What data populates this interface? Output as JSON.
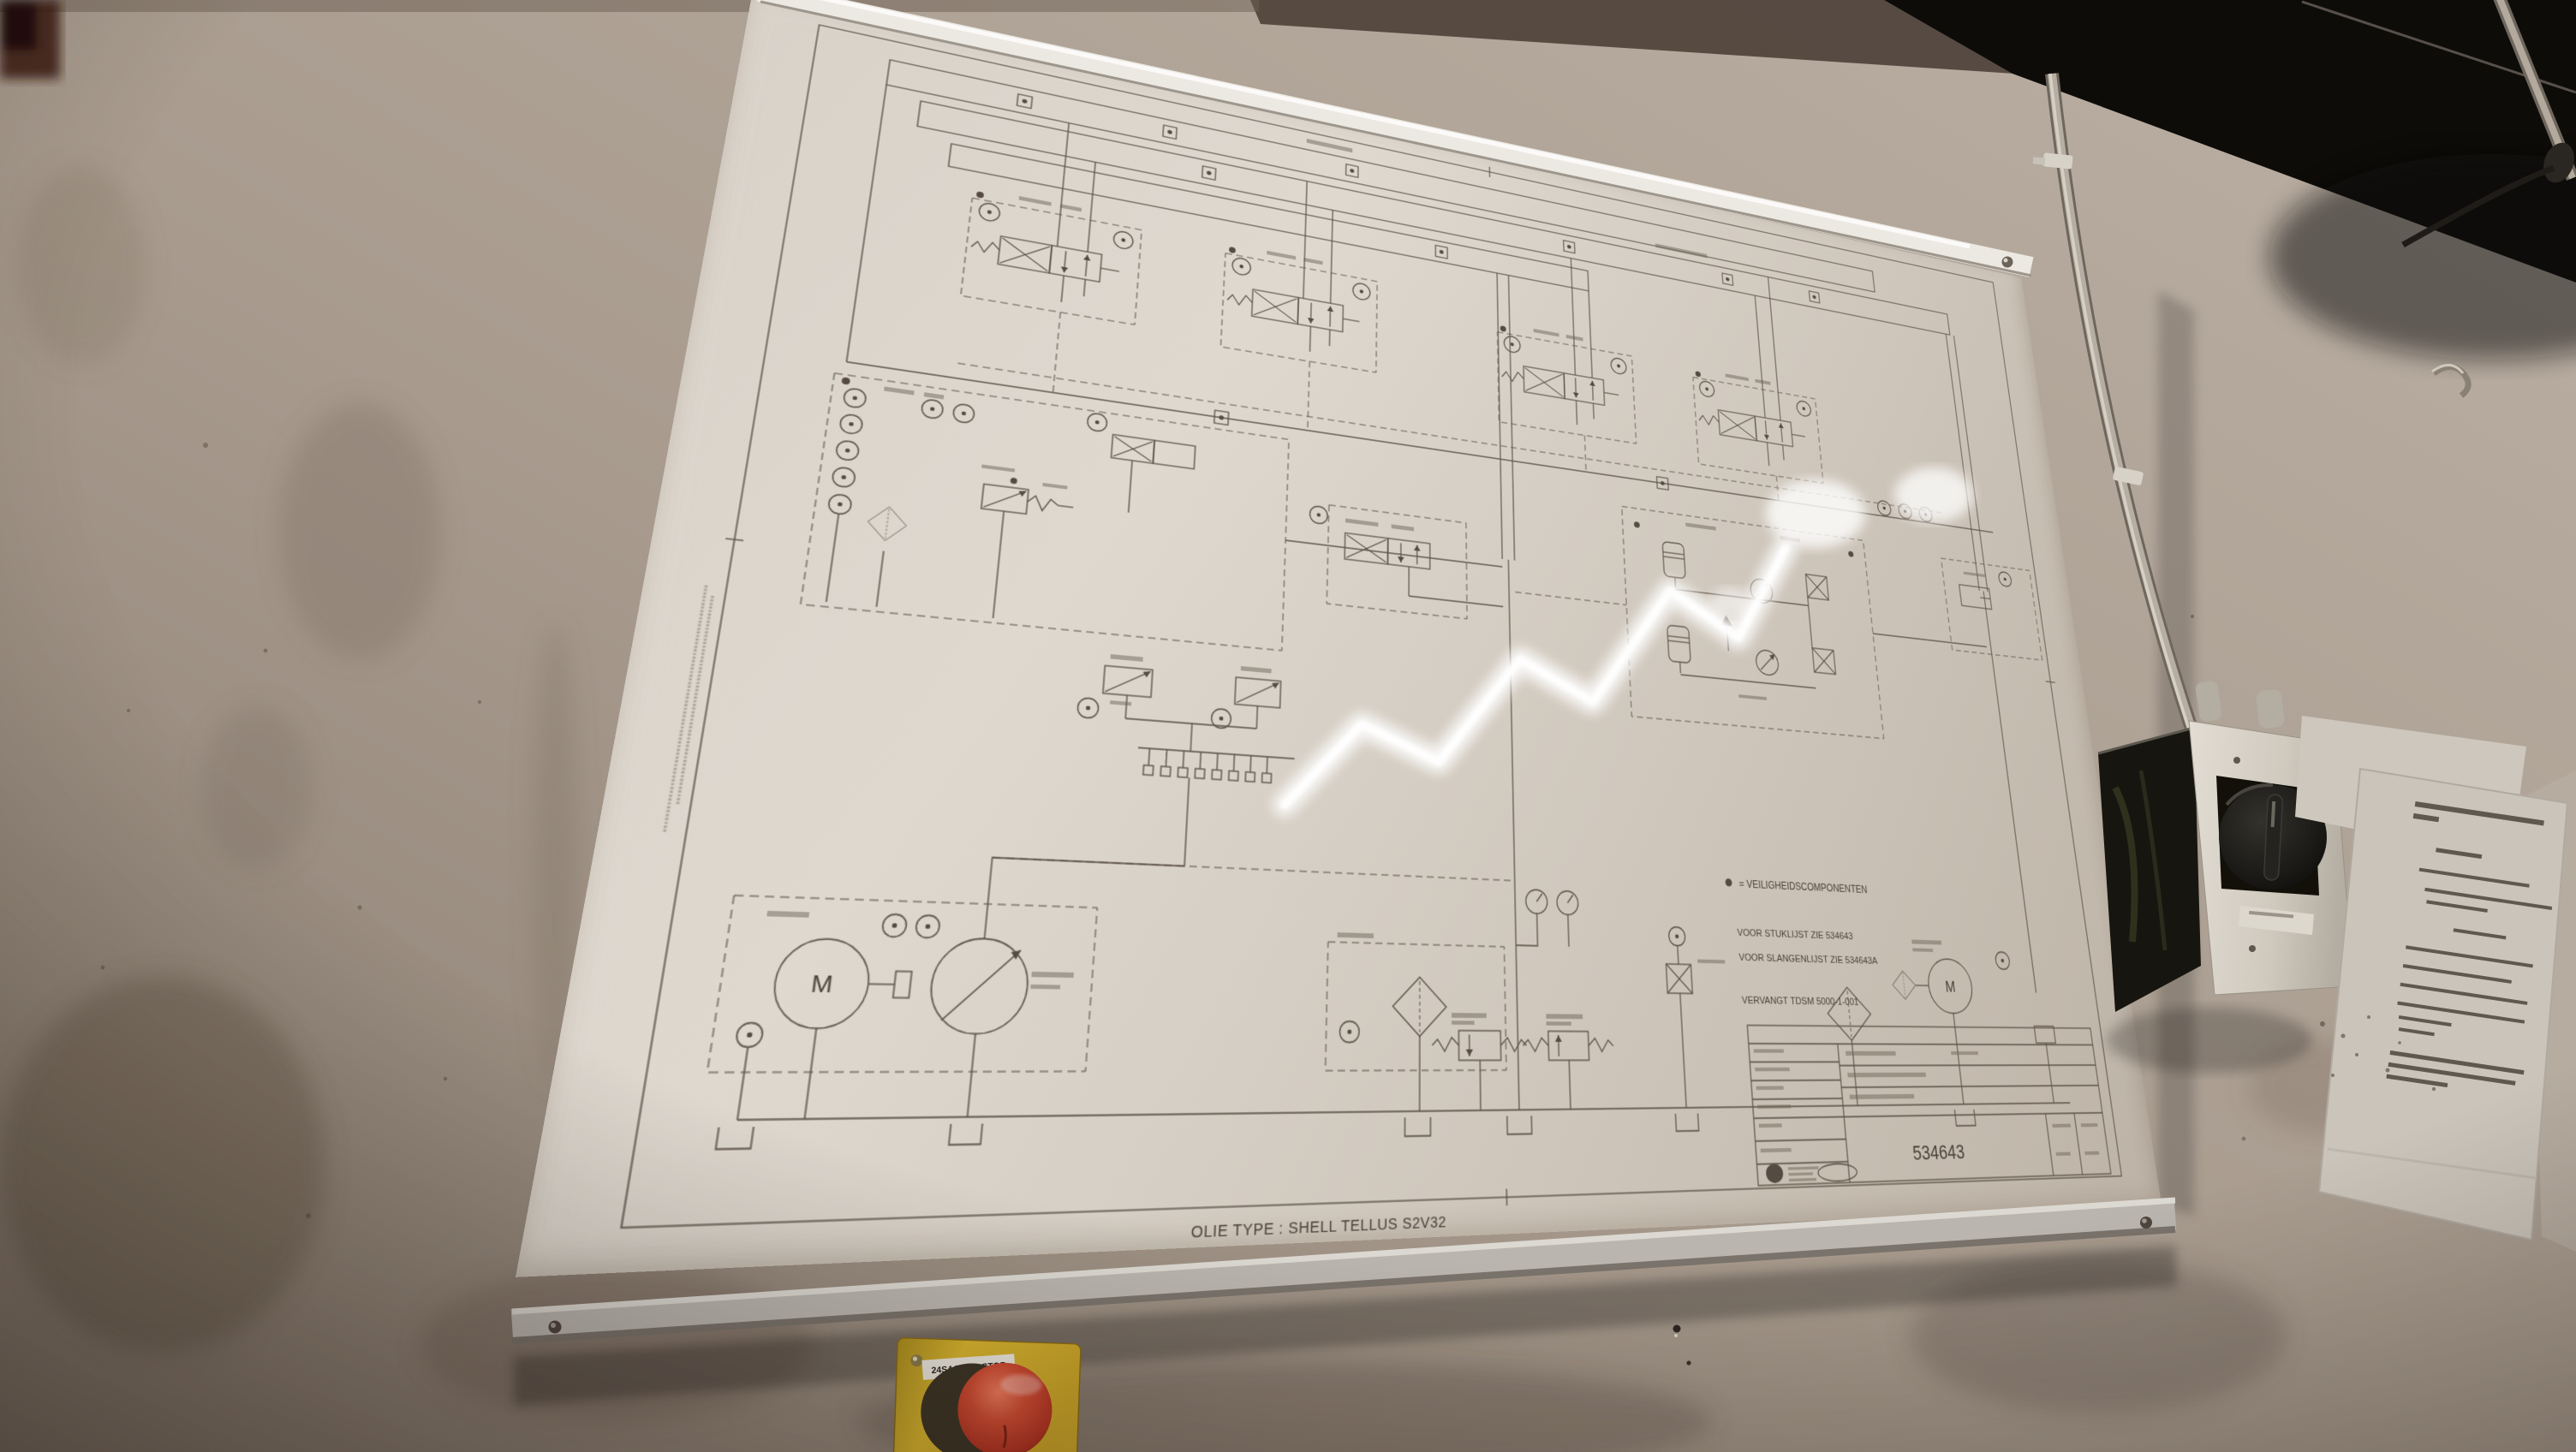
{
  "poster": {
    "schematic_notes": {
      "safety_marker": "●",
      "safety_note": "= VEILIGHEIDSCOMPONENTEN",
      "parts_list_note": "VOOR STUKLIJST ZIE 534643",
      "hose_list_note": "VOOR SLANGENLIJST ZIE 534643A",
      "replaces_note": "VERVANGT TDSM 5000-1-001"
    },
    "oil_type_note": "OLIE TYPE : SHELL TELLUS S2V32",
    "title_block": {
      "drawing_number": "534643"
    },
    "motor_symbol_label": "M"
  },
  "estop": {
    "label": "24S4 NOODSTOP"
  },
  "colors": {
    "wall": "#a4978b",
    "poster_paper": "#d5cec5",
    "schematic_line": "#5d5348",
    "rail_aluminum": "#d8d5cf",
    "estop_box_yellow": "#d9b52f",
    "estop_button_red": "#c24530",
    "switch_knob_black": "#16140f",
    "ceiling_shadow": "#0e0c09"
  }
}
